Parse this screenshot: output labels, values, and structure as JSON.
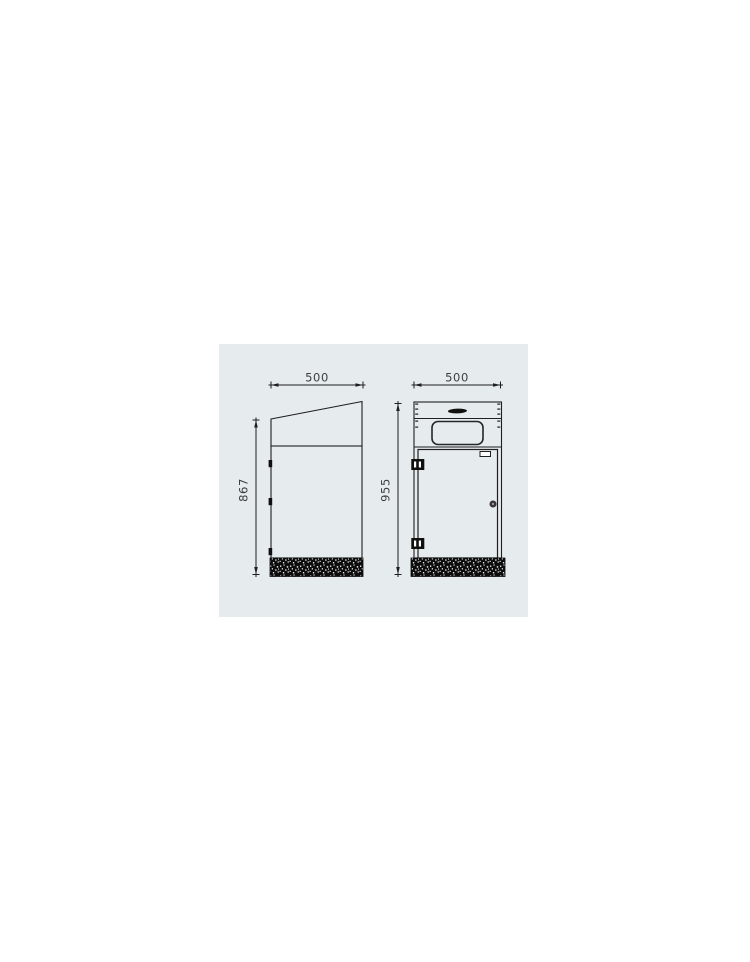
{
  "panel": {
    "background": "#e6ebee"
  },
  "drawing": {
    "line_color": "#1f1f1f",
    "dim_text_color": "#3c3c3c",
    "base_fill": "#0d0d0d",
    "side_view": {
      "width_label": "500",
      "height_label": "867"
    },
    "front_view": {
      "width_label": "500",
      "height_label": "955"
    }
  }
}
